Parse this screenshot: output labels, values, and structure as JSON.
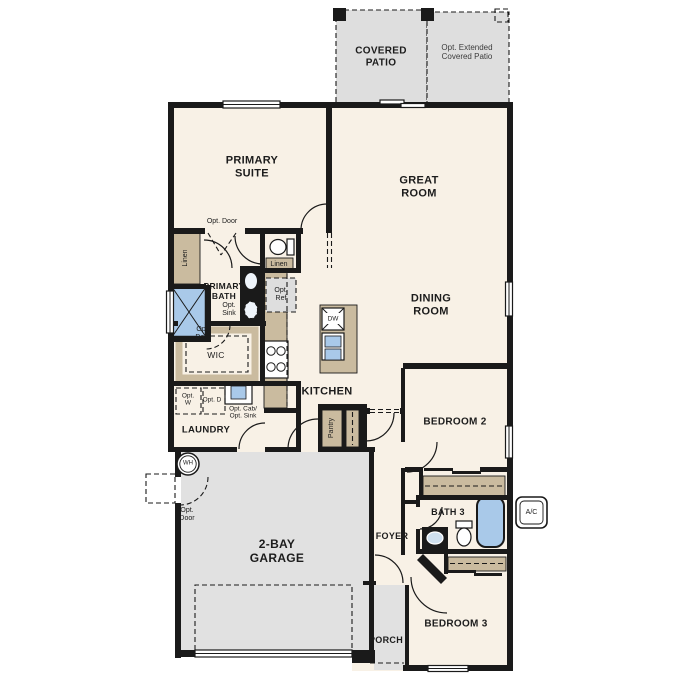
{
  "rooms": {
    "covered_patio": "COVERED PATIO",
    "opt_extended_patio": "Opt. Extended Covered Patio",
    "primary_suite": "PRIMARY SUITE",
    "great_room": "GREAT ROOM",
    "dining_room": "DINING ROOM",
    "primary_bath": "PRIMARY BATH",
    "wic": "WIC",
    "kitchen": "KITCHEN",
    "laundry": "LAUNDRY",
    "garage": "2-BAY GARAGE",
    "bedroom2": "BEDROOM 2",
    "bath3": "BATH 3",
    "foyer": "FOYER",
    "porch": "PORCH",
    "bedroom3": "BEDROOM 3"
  },
  "annotations": {
    "opt_door": "Opt. Door",
    "linen": "Linen",
    "opt_sink": "Opt. Sink",
    "opt_ref": "Opt. Ref",
    "opt_w": "Opt. W",
    "opt_d": "Opt. D",
    "opt_cab_sink": "Opt. Cab/ Opt. Sink",
    "pantry": "Pantry"
  },
  "fixtures": {
    "dw": "DW",
    "wh": "WH",
    "ac": "A/C"
  },
  "colors": {
    "floor": "#f8f1e6",
    "outdoor": "#e1e1e1",
    "wall": "#1a1a1a",
    "cabinet": "#cabb9f",
    "fixture_blue": "#a9c9e9",
    "dashed_fill": "#dedede",
    "text": "#1c1c1c",
    "muted_text": "#3c3c3c"
  }
}
